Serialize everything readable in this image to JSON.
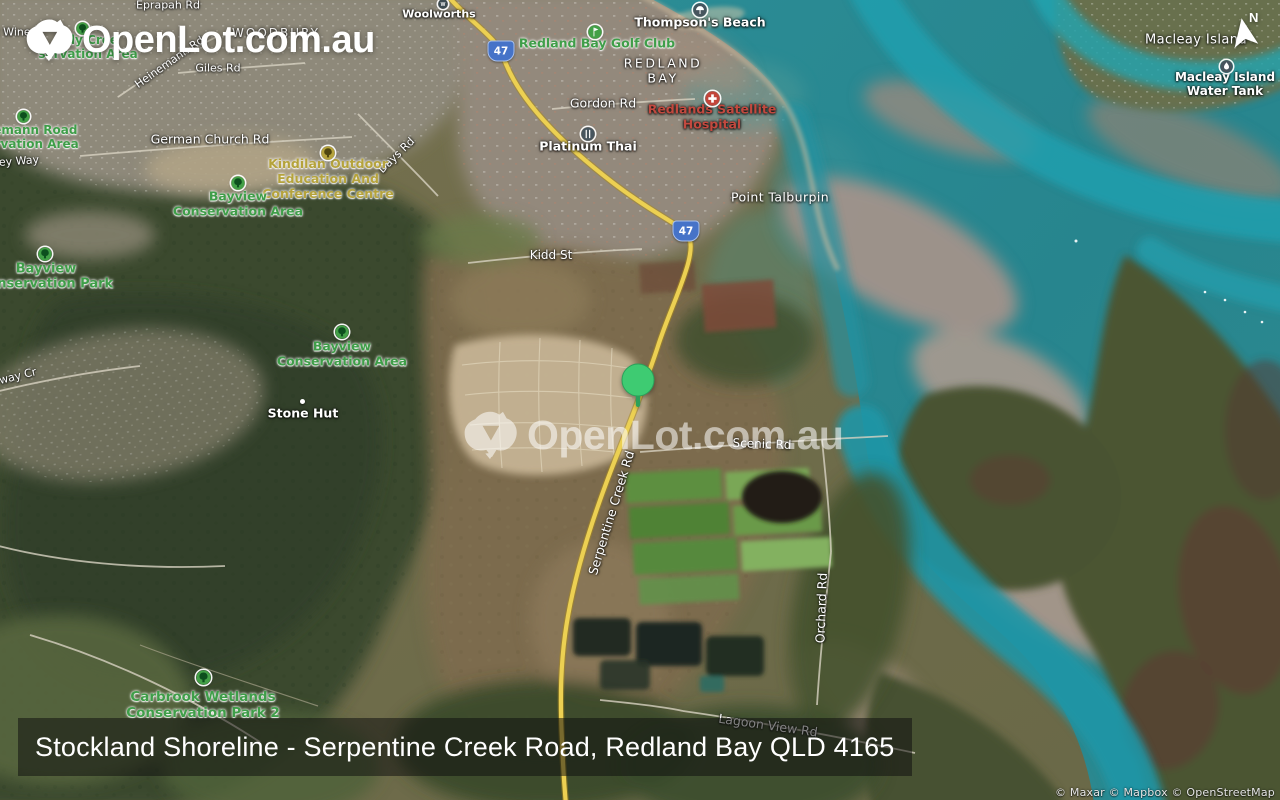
{
  "branding": {
    "logo_text": "OpenLot.com.au",
    "watermark_text": "OpenLot.com.au"
  },
  "compass": {
    "label": "N"
  },
  "title_bar": {
    "text": "Stockland Shoreline - Serpentine Creek Road, Redland Bay QLD 4165"
  },
  "attribution": {
    "text": "© Maxar © Mapbox © OpenStreetMap"
  },
  "colors": {
    "pin": "#3ecb72",
    "park_label": "#3f9e49",
    "kindilan_label": "#b5a33c",
    "hospital_label": "#c2493f",
    "shield_blue": "#4673c8",
    "water_teal": "#27858e",
    "road_yellow": "#ecd052"
  },
  "map": {
    "pin": {
      "x": 638,
      "y": 380
    },
    "highway_shields": [
      {
        "label": "47",
        "x": 501,
        "y": 51
      },
      {
        "label": "47",
        "x": 686,
        "y": 231
      }
    ],
    "icons": [
      {
        "type": "shop",
        "x": 443,
        "y": 4,
        "d": 10
      },
      {
        "type": "beach",
        "x": 700,
        "y": 10,
        "d": 14
      },
      {
        "type": "golf",
        "x": 595,
        "y": 32,
        "d": 14
      },
      {
        "type": "restaurant",
        "x": 588,
        "y": 134,
        "d": 14
      },
      {
        "type": "hospital",
        "x": 712,
        "y": 98,
        "d": 15
      },
      {
        "type": "water",
        "x": 1226,
        "y": 66,
        "d": 13
      },
      {
        "type": "dot",
        "x": 302,
        "y": 401,
        "d": 5
      },
      {
        "type": "park",
        "x": 82,
        "y": 28,
        "d": 13
      },
      {
        "type": "park",
        "x": 23,
        "y": 116,
        "d": 13
      },
      {
        "type": "park",
        "x": 238,
        "y": 183,
        "d": 14
      },
      {
        "type": "park",
        "x": 45,
        "y": 254,
        "d": 14
      },
      {
        "type": "park",
        "x": 342,
        "y": 332,
        "d": 14
      },
      {
        "type": "kindilan",
        "x": 328,
        "y": 153,
        "d": 14
      },
      {
        "type": "park",
        "x": 203,
        "y": 677,
        "d": 15
      }
    ],
    "labels": [
      {
        "id": "eprapah-rd",
        "kind": "road",
        "lines": [
          "Eprapah Rd"
        ],
        "x": 168,
        "y": 6,
        "s": 11
      },
      {
        "id": "t-wine",
        "kind": "road",
        "lines": [
          "t Wine"
        ],
        "x": 13,
        "y": 33,
        "s": 11
      },
      {
        "id": "woodbury",
        "kind": "suburb",
        "lines": [
          "WOODBURY"
        ],
        "x": 276,
        "y": 33,
        "s": 12,
        "ls": 2,
        "op": 0.9
      },
      {
        "id": "giles-rd",
        "kind": "road",
        "lines": [
          "Giles Rd"
        ],
        "x": 218,
        "y": 69,
        "s": 11
      },
      {
        "id": "heinemann-rd",
        "kind": "road",
        "lines": [
          "Heinemann Rd"
        ],
        "x": 170,
        "y": 63,
        "s": 11,
        "r": -35
      },
      {
        "id": "sandy-cree-conservation",
        "kind": "park",
        "lines": [
          "ndy Cree",
          "servation Area"
        ],
        "x": 88,
        "y": 47,
        "s": 12
      },
      {
        "id": "heinemann-road-conservation",
        "kind": "park",
        "lines": [
          "inemann Road",
          "servation Area"
        ],
        "x": 29,
        "y": 137,
        "s": 12
      },
      {
        "id": "german-church-rd",
        "kind": "road",
        "lines": [
          "German Church Rd"
        ],
        "x": 210,
        "y": 140,
        "s": 12.5
      },
      {
        "id": "ey-way",
        "kind": "road",
        "lines": [
          "ey Way"
        ],
        "x": 19,
        "y": 162,
        "s": 11,
        "r": -4
      },
      {
        "id": "days-rd",
        "kind": "road",
        "lines": [
          "Days Rd"
        ],
        "x": 397,
        "y": 156,
        "s": 11,
        "r": -44
      },
      {
        "id": "woolworths",
        "kind": "poi",
        "lines": [
          "Woolworths"
        ],
        "x": 439,
        "y": 15,
        "s": 11
      },
      {
        "id": "thompsons-beach",
        "kind": "poi",
        "lines": [
          "Thompson's Beach"
        ],
        "x": 700,
        "y": 23,
        "s": 12.5
      },
      {
        "id": "redland-bay-golf-club",
        "kind": "park",
        "lines": [
          "Redland Bay Golf Club"
        ],
        "x": 597,
        "y": 44,
        "s": 12.5
      },
      {
        "id": "redland-bay",
        "kind": "suburb",
        "lines": [
          "REDLAND",
          "BAY"
        ],
        "x": 663,
        "y": 71,
        "s": 12.5,
        "ls": 2.5
      },
      {
        "id": "gordon-rd",
        "kind": "road",
        "lines": [
          "Gordon Rd"
        ],
        "x": 603,
        "y": 104,
        "s": 12.5
      },
      {
        "id": "platinum-thai",
        "kind": "poi",
        "lines": [
          "Platinum Thai"
        ],
        "x": 588,
        "y": 147,
        "s": 12.5
      },
      {
        "id": "redlands-satellite-hospital",
        "kind": "poi",
        "lines": [
          "Redlands Satellite",
          "Hospital"
        ],
        "x": 712,
        "y": 117,
        "s": 12.5,
        "color": "#c2493f"
      },
      {
        "id": "kindilan-outdoor-education",
        "kind": "park",
        "lines": [
          "Kindilan Outdoor",
          "Education And",
          "Conference Centre"
        ],
        "x": 328,
        "y": 179,
        "s": 12.5,
        "color": "#b5a33c"
      },
      {
        "id": "point-talburpin",
        "kind": "locality",
        "lines": [
          "Point Talburpin"
        ],
        "x": 780,
        "y": 198,
        "s": 12.5
      },
      {
        "id": "bayview-conservation-area-north",
        "kind": "park",
        "lines": [
          "Bayview",
          "Conservation Area"
        ],
        "x": 238,
        "y": 204,
        "s": 12.5
      },
      {
        "id": "kidd-st",
        "kind": "road",
        "lines": [
          "Kidd St"
        ],
        "x": 551,
        "y": 255,
        "s": 12
      },
      {
        "id": "bayview-conservation-park",
        "kind": "park",
        "lines": [
          "Bayview",
          "Conservation Park"
        ],
        "x": 46,
        "y": 277,
        "s": 13
      },
      {
        "id": "bayview-conservation-area",
        "kind": "park",
        "lines": [
          "Bayview",
          "Conservation Area"
        ],
        "x": 342,
        "y": 354,
        "s": 12.5
      },
      {
        "id": "way-cr",
        "kind": "road",
        "lines": [
          "way Cr"
        ],
        "x": 18,
        "y": 377,
        "s": 11,
        "r": -14
      },
      {
        "id": "stone-hut",
        "kind": "poi",
        "lines": [
          "Stone Hut"
        ],
        "x": 303,
        "y": 414,
        "s": 12.5
      },
      {
        "id": "scenic-rd",
        "kind": "road",
        "lines": [
          "Scenic Rd"
        ],
        "x": 762,
        "y": 444,
        "s": 12,
        "r": 2
      },
      {
        "id": "serpentine-creek-rd",
        "kind": "road",
        "lines": [
          "Serpentine Creek Rd"
        ],
        "x": 612,
        "y": 513,
        "s": 12.5,
        "r": -73
      },
      {
        "id": "orchard-rd",
        "kind": "road",
        "lines": [
          "Orchard Rd"
        ],
        "x": 822,
        "y": 608,
        "s": 12.5,
        "r": -88
      },
      {
        "id": "carbrook-wetlands-conservation-park-2",
        "kind": "park",
        "lines": [
          "Carbrook Wetlands",
          "Conservation Park 2"
        ],
        "x": 203,
        "y": 706,
        "s": 13.5
      },
      {
        "id": "lagoon-view-rd",
        "kind": "road",
        "lines": [
          "Lagoon View Rd"
        ],
        "x": 768,
        "y": 726,
        "s": 12.5,
        "r": 8
      },
      {
        "id": "macleay-island",
        "kind": "locality",
        "lines": [
          "Macleay Island"
        ],
        "x": 1196,
        "y": 40,
        "s": 13
      },
      {
        "id": "macleay-island-water-tank",
        "kind": "poi",
        "lines": [
          "Macleay Island",
          "Water Tank"
        ],
        "x": 1225,
        "y": 84,
        "s": 12
      }
    ]
  }
}
